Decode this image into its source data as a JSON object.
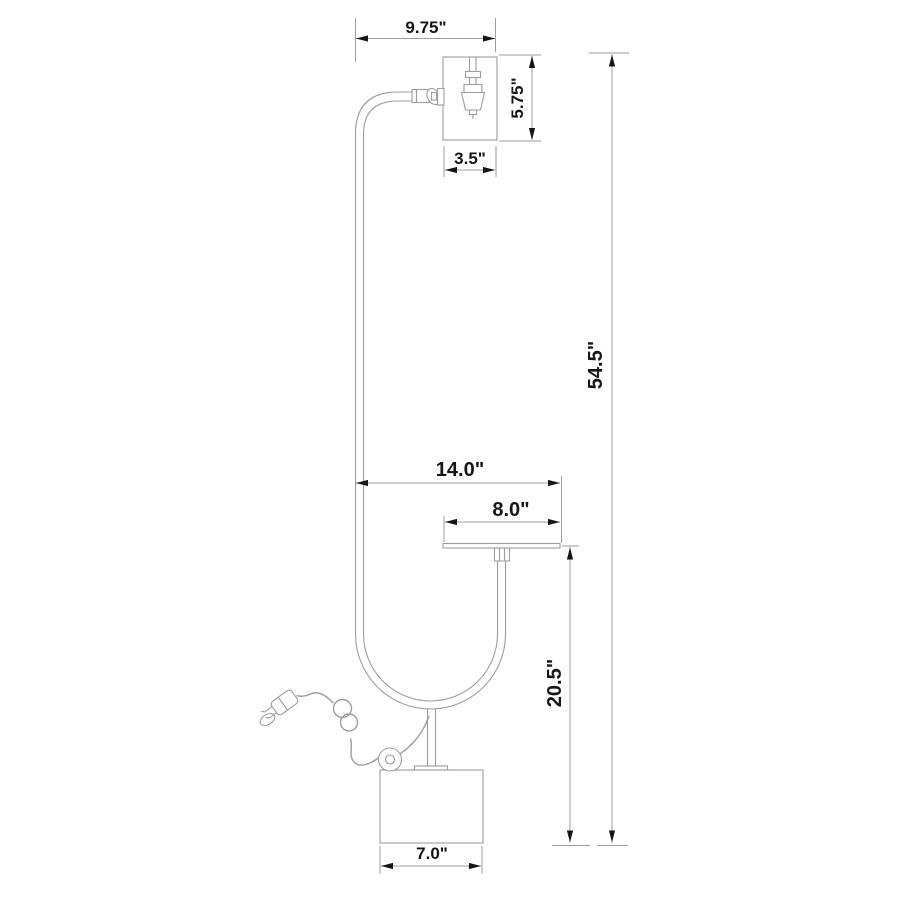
{
  "colors": {
    "background": "#ffffff",
    "lamp_outline": "#9d9d9d",
    "dimension_line": "#9d9d9d",
    "dimension_accent": "#151515"
  },
  "dimensions": {
    "shade_top_span": {
      "label": "9.75\"",
      "value": 9.75,
      "unit": "in"
    },
    "shade_height": {
      "label": "5.75\"",
      "value": 5.75,
      "unit": "in"
    },
    "shade_width": {
      "label": "3.5\"",
      "value": 3.5,
      "unit": "in"
    },
    "overall_height": {
      "label": "54.5\"",
      "value": 54.5,
      "unit": "in"
    },
    "tray_span": {
      "label": "14.0\"",
      "value": 14.0,
      "unit": "in"
    },
    "tray_width": {
      "label": "8.0\"",
      "value": 8.0,
      "unit": "in"
    },
    "tray_height": {
      "label": "20.5\"",
      "value": 20.5,
      "unit": "in"
    },
    "base_width": {
      "label": "7.0\"",
      "value": 7.0,
      "unit": "in"
    }
  }
}
